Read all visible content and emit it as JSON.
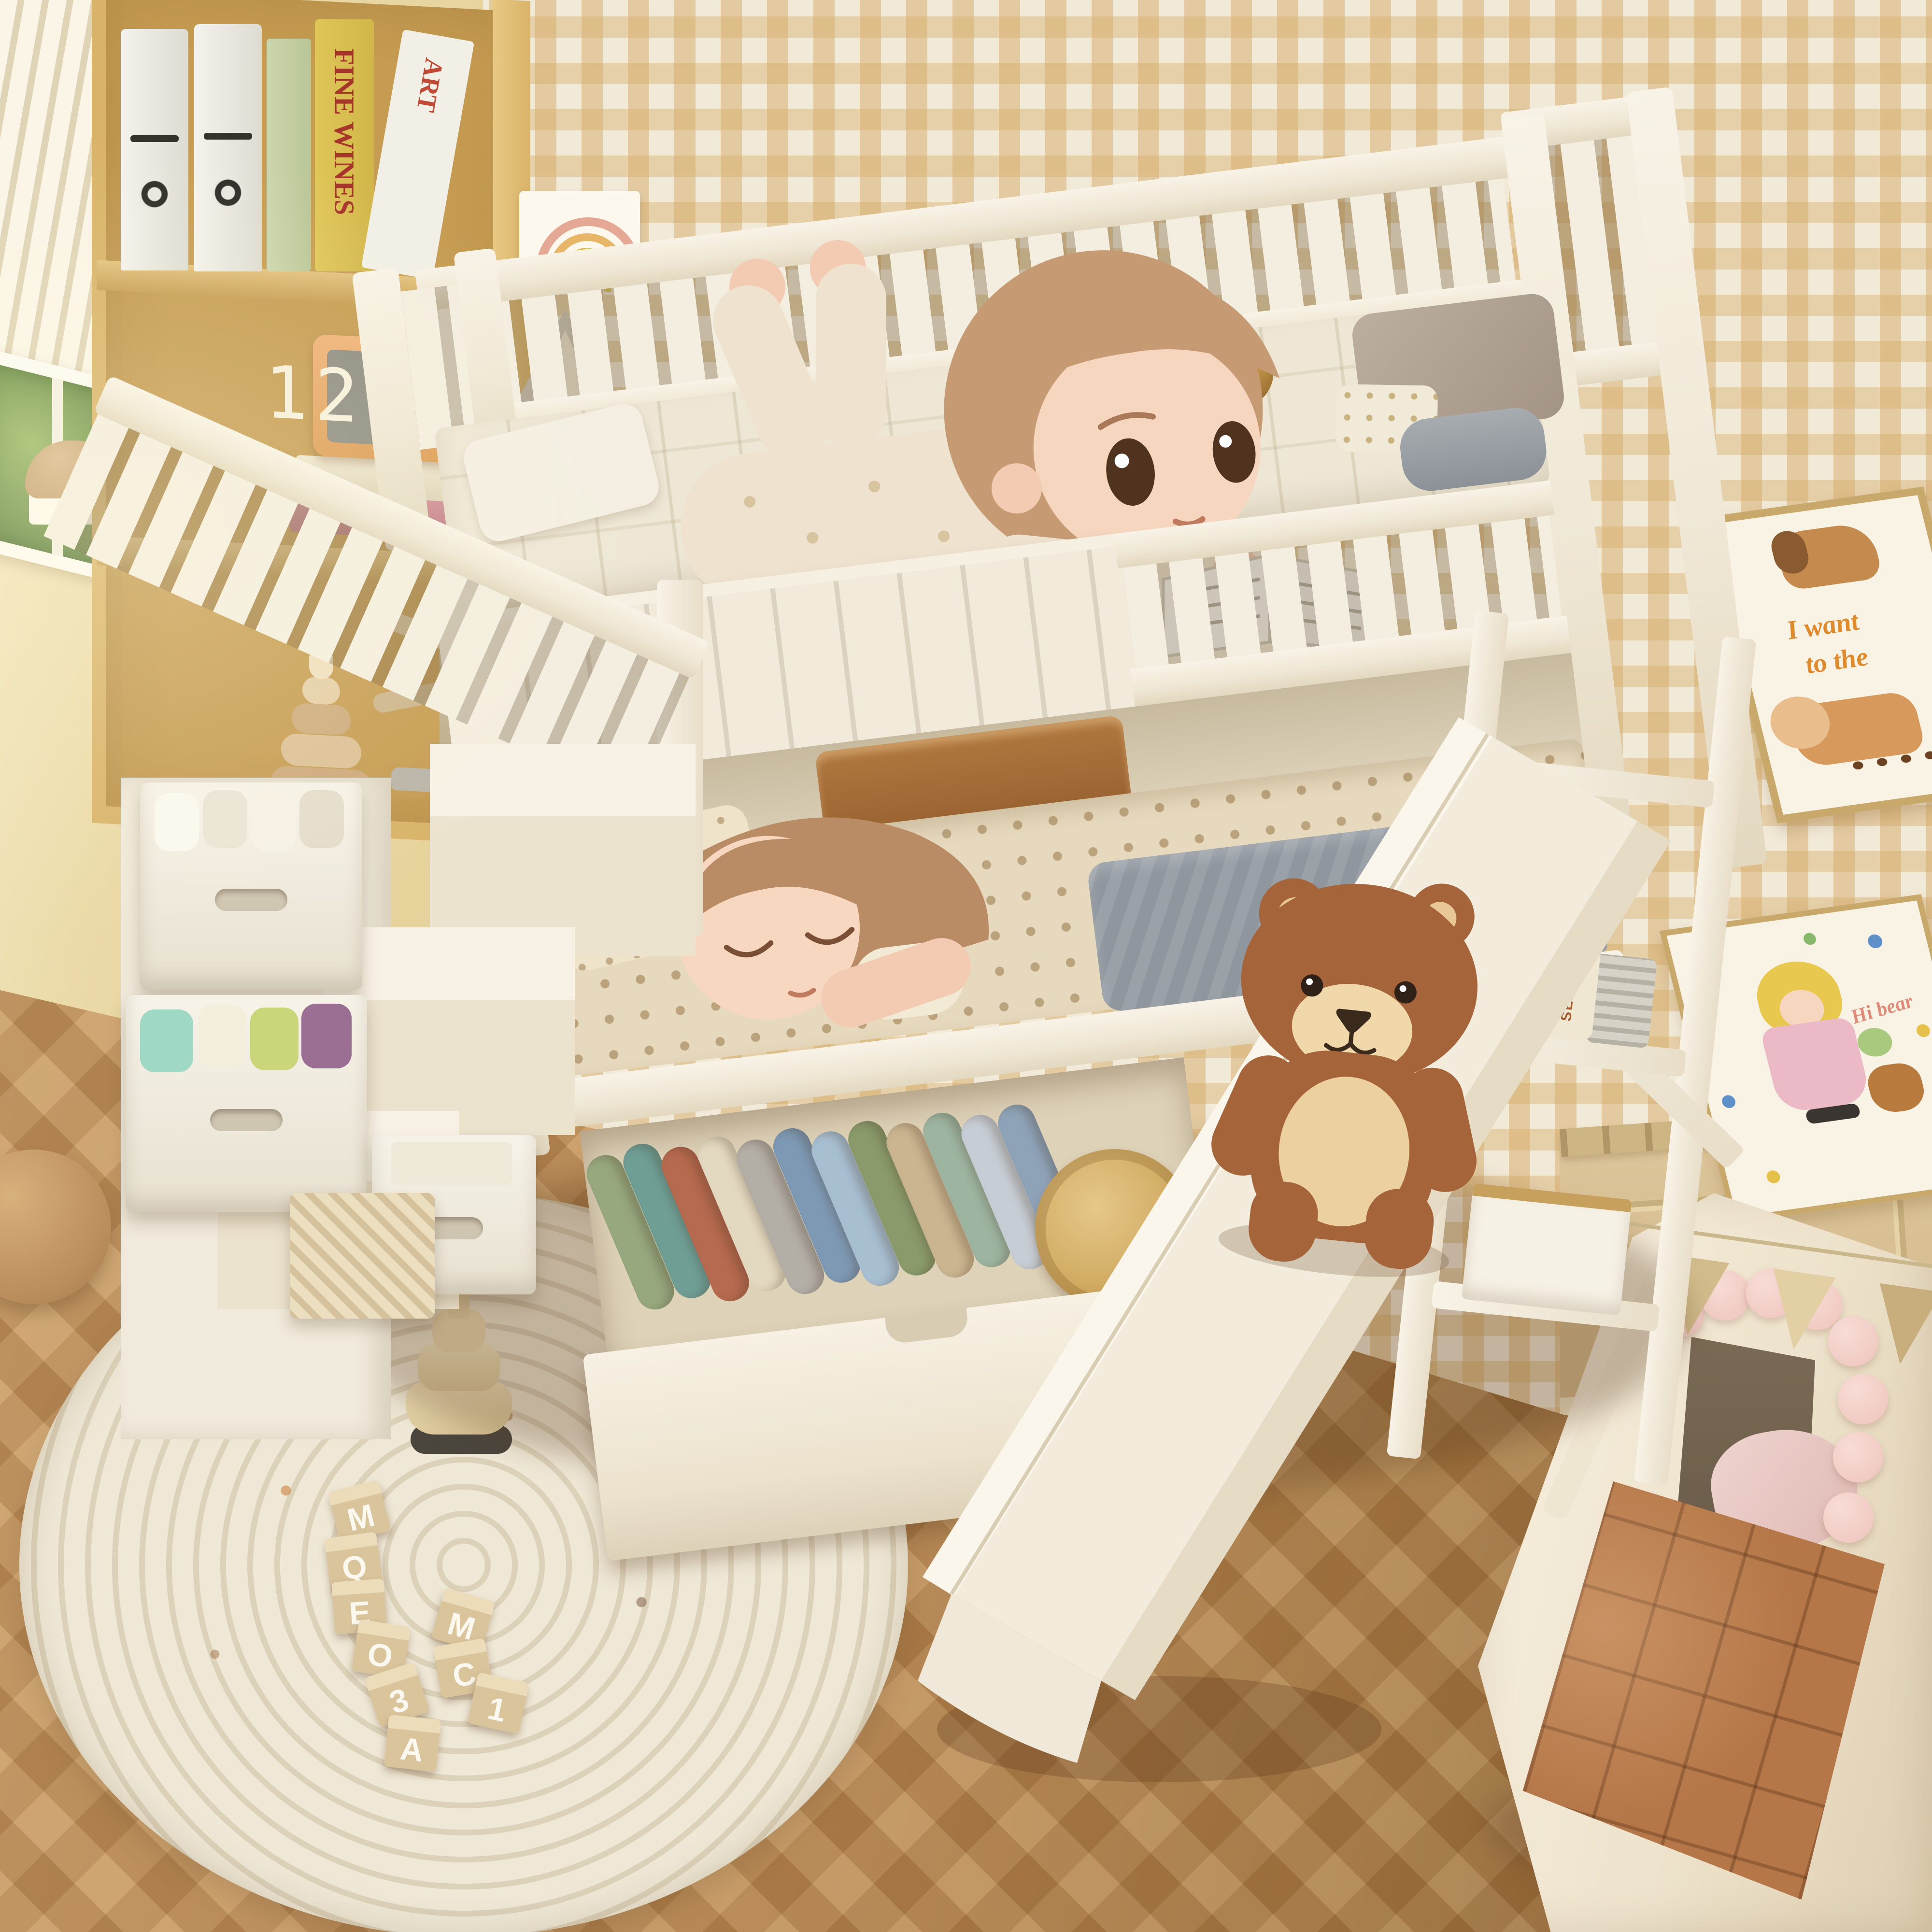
{
  "scene": {
    "type": "3d-room-render",
    "description": "Overhead view of a children's bedroom: cream bunk bed with storage staircase and fabric bins, pulled-out under-bed clothes drawer, slide with a teddy bear, girl reading on the top bunk, girl sleeping on the bottom bunk, round braided rug with alphabet blocks, play teepee with pom-poms and quilted mat, bookshelf with toys and digital clock, yellow gingham wallpaper and herringbone wood floor.",
    "colors": {
      "wall_left": "#ead9a6",
      "wallpaper_base": "#f2ead8",
      "wallpaper_check": "#d6ab68",
      "lower_wall": "#dcc59a",
      "floor_wood": "#bc8d58",
      "bed_cream": "#f4eee1",
      "mattress": "#eee7d6",
      "bolster_gold": "#c69a4c",
      "blanket_gray": "#8f969d",
      "blanket_polka": "#e7d9bd",
      "hair_reading_girl": "#c69b74",
      "hair_sleeping_girl": "#b98c66",
      "skin": "#f6d6bf",
      "teddy_brown": "#a5643a",
      "teddy_tan": "#ecd0a0",
      "rug_cream": "#ebe4d2",
      "tent_canvas": "#f4ecdc",
      "mat_brown": "#b57748",
      "pompom_pink": "#f3d3cc",
      "bookshelf_wood": "#d9b369",
      "clock_case": "#e5a766",
      "clock_screen": "#8d8c82",
      "clock_digits": "#f7f1dd"
    }
  },
  "bookshelf": {
    "clock_time": "12:34",
    "book_spine_yellow": "FINE WINES",
    "book_spine_white": "ART"
  },
  "posters": {
    "dogs_line1": "I want",
    "dogs_line2": "to the",
    "girl_text": "Hi bear"
  },
  "shelf": {
    "bottle_label": "SEALIFE"
  },
  "rug": {
    "blocks": [
      "M",
      "Q",
      "E",
      "O",
      "3",
      "A",
      "M",
      "C",
      "1"
    ]
  },
  "drawer": {
    "clothes_colors": [
      "#97a87e",
      "#6f9e95",
      "#b66a4f",
      "#e3d8c0",
      "#b3aea6",
      "#7e99b4",
      "#a8bfd2",
      "#8a9a6b",
      "#cbb591",
      "#9db4a0",
      "#c7cdd4",
      "#8fa3b8"
    ],
    "hat_color": "#d9b472"
  },
  "stairs": {
    "bin_contents_colors": [
      "#ffffff",
      "#9fd8c5",
      "#f4eedd",
      "#cbd67a",
      "#9a6f93"
    ]
  }
}
